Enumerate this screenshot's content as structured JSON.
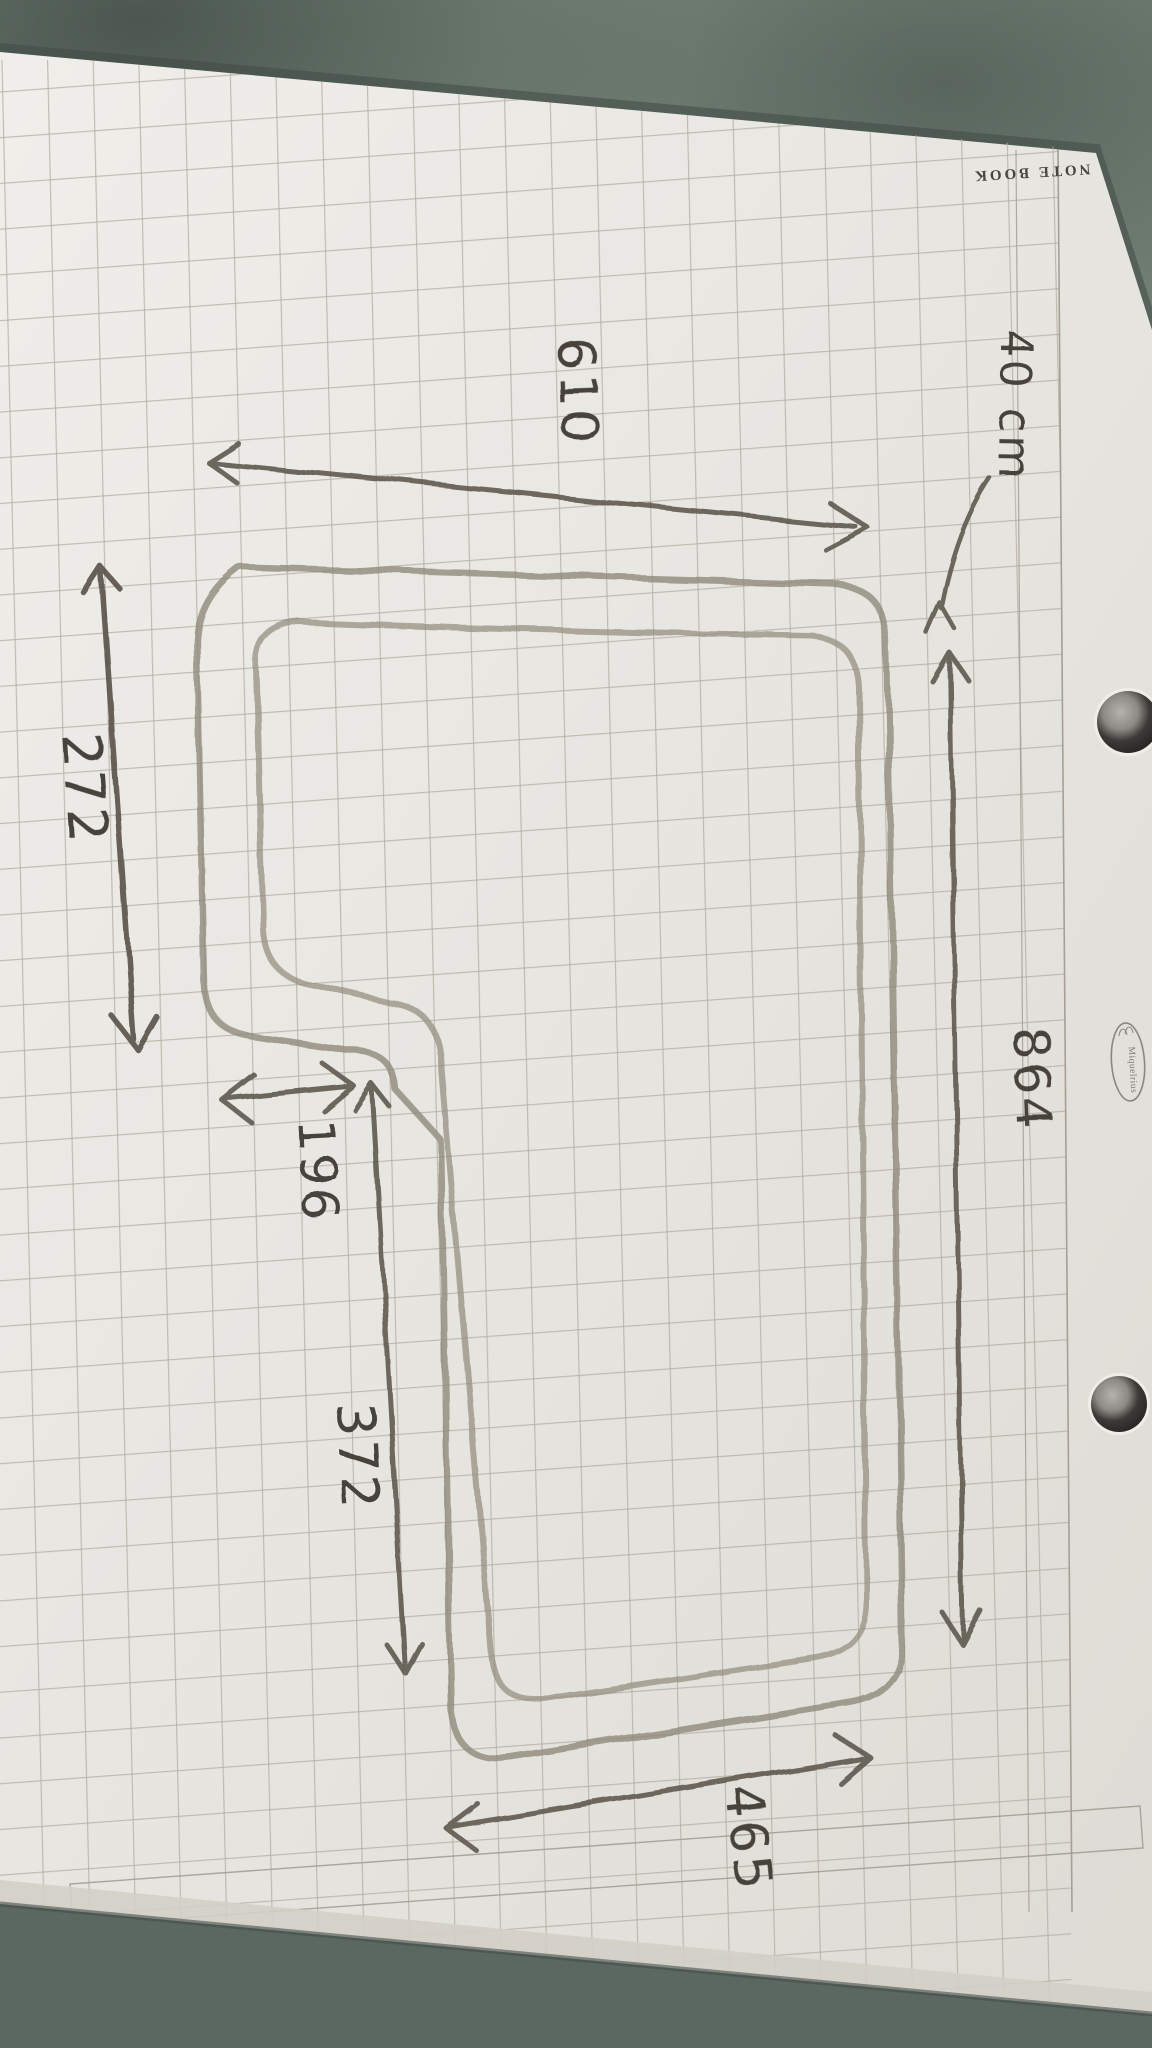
{
  "photo": {
    "description": "Photograph of a hand-drawn dimensioned sketch (double-walled L-shaped outline, like a pool or room plan) in pencil on squared notebook paper, page rotated sideways on a green-grey stone surface",
    "surface": "green-grey stone table"
  },
  "paper": {
    "print_header": "NOTE BOOK",
    "brand": "Miquelrius",
    "holes": 2
  },
  "sketch": {
    "unit_annotation": "40 cm",
    "labels": {
      "top_width": "610",
      "upper_left": "272",
      "step_width": "196",
      "lower_left": "372",
      "right_side": "864",
      "bottom_width": "465"
    }
  },
  "colors": {
    "pencil_wall": "#8f897b",
    "pencil_line": "#5f5a50",
    "paper": "#e8e6e1",
    "grid": "#b3ada2",
    "table": "#6d7b70"
  }
}
